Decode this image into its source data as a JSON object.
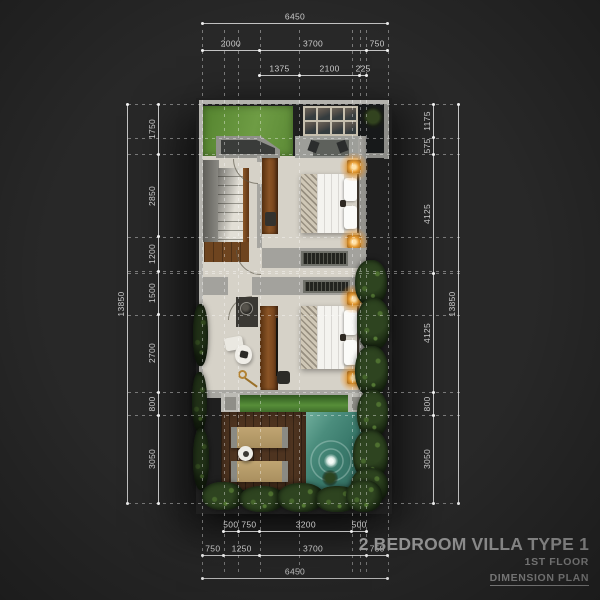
{
  "title_block": {
    "title": "2 BEDROOM VILLA TYPE 1",
    "floor": "1ST FLOOR",
    "plan_type": "DIMENSION PLAN"
  },
  "dimensions": {
    "unit": "mm",
    "overall_width": 6450,
    "overall_height": 13850,
    "top": [
      [
        6450
      ],
      [
        2000,
        3700,
        750
      ],
      [
        1375,
        2100,
        225
      ]
    ],
    "bottom": [
      [
        500,
        750,
        3200,
        500
      ],
      [
        750,
        1250,
        3700,
        750
      ],
      [
        6450
      ]
    ],
    "left": [
      [
        1750,
        2850,
        1200,
        1500,
        2700,
        800,
        3050
      ],
      [
        13850
      ]
    ],
    "right": [
      [
        1175,
        575,
        4125,
        4125,
        800,
        3050
      ],
      [
        13850
      ]
    ]
  },
  "plan_features": [
    "front-yard-grass",
    "skylight-canopy",
    "entry-porch",
    "staircase",
    "hallway",
    "bedroom-1-bed",
    "bedroom-2-bed",
    "nightstand-lamps",
    "louver-vents",
    "wardrobes",
    "bathroom-vanity",
    "toilet",
    "planter-strip",
    "sun-deck",
    "loungers",
    "side-table",
    "swimming-pool",
    "hedges",
    "courtyard"
  ],
  "colors": {
    "background": "#282828",
    "floor": "#d6d2c8",
    "wall": "#a6a5a0",
    "grass_lawn": "#5f8f3c",
    "pool_water": "#3a7a6c",
    "deck_wood": "#4e3420",
    "hedge_foliage": "#22331a",
    "lamp_glow": "#f0a040",
    "dimension_text": "#cbcbcb",
    "title_text": "#9b9b9b"
  }
}
